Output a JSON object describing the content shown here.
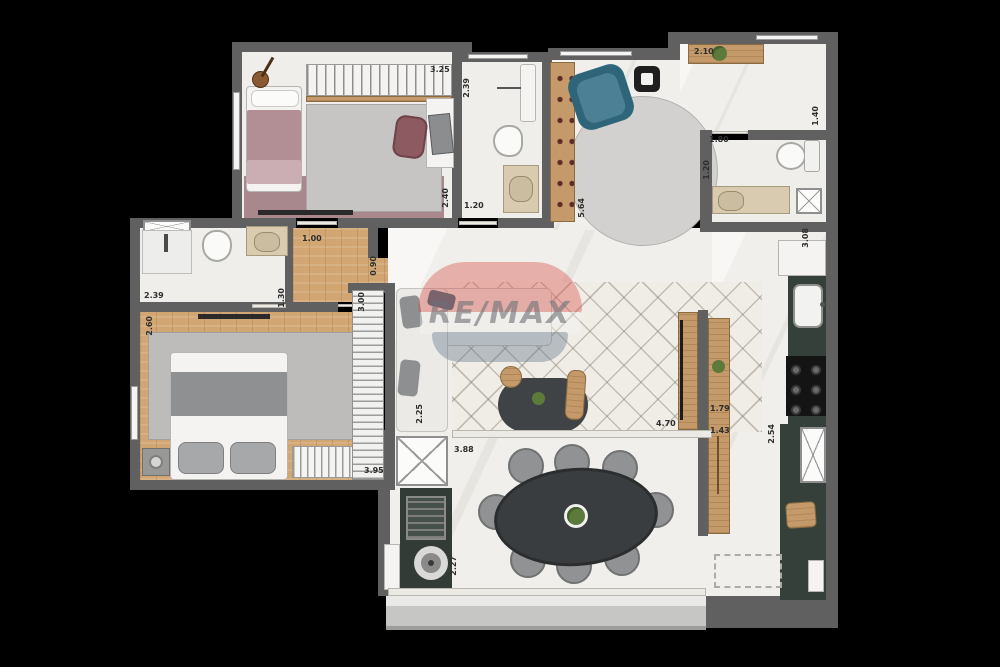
{
  "watermark": {
    "brand": "RE/MAX"
  },
  "colors": {
    "background": "#000000",
    "wall": "#606060",
    "floor_white": "#efeeea",
    "floor_wood": "#d2a673",
    "furniture_wood": "#c49a6a",
    "kitchen_cabinet": "#36403b",
    "rug_gray": "#bdbcba",
    "armchair_teal": "#3f7486",
    "bed_mauve": "#b28f95",
    "remax_red": "#d94a43",
    "remax_blue": "#5e7287"
  },
  "dimensions": [
    {
      "id": "bedroom1-width-top",
      "text": "3.25"
    },
    {
      "id": "bathroom1-depth",
      "text": "2.39"
    },
    {
      "id": "bedroom1-depth-right",
      "text": "2.40"
    },
    {
      "id": "bathroom1-width-bottom",
      "text": "1.20"
    },
    {
      "id": "living-upper-depth",
      "text": "5.64"
    },
    {
      "id": "sideboard-width",
      "text": "2.10"
    },
    {
      "id": "entry-width",
      "text": "1.40"
    },
    {
      "id": "bathroom2-width",
      "text": "1.80"
    },
    {
      "id": "bathroom2-depth",
      "text": "1.20"
    },
    {
      "id": "kitchen-counter-top",
      "text": "3.08"
    },
    {
      "id": "hallway-width",
      "text": "1.00"
    },
    {
      "id": "hall-opening",
      "text": "0.90"
    },
    {
      "id": "bathroom3-depth",
      "text": "1.30"
    },
    {
      "id": "bathroom3-width",
      "text": "2.39"
    },
    {
      "id": "bedroom2-depth-left",
      "text": "2.60"
    },
    {
      "id": "closet-length",
      "text": "3.00"
    },
    {
      "id": "sofa-chaise",
      "text": "2.25"
    },
    {
      "id": "bedroom2-width",
      "text": "3.95"
    },
    {
      "id": "living-opening",
      "text": "4.70"
    },
    {
      "id": "island-length",
      "text": "1.79"
    },
    {
      "id": "island-offset",
      "text": "1.43"
    },
    {
      "id": "kitchen-depth",
      "text": "2.54"
    },
    {
      "id": "dining-width",
      "text": "3.88"
    },
    {
      "id": "dining-depth",
      "text": "2.27"
    }
  ]
}
